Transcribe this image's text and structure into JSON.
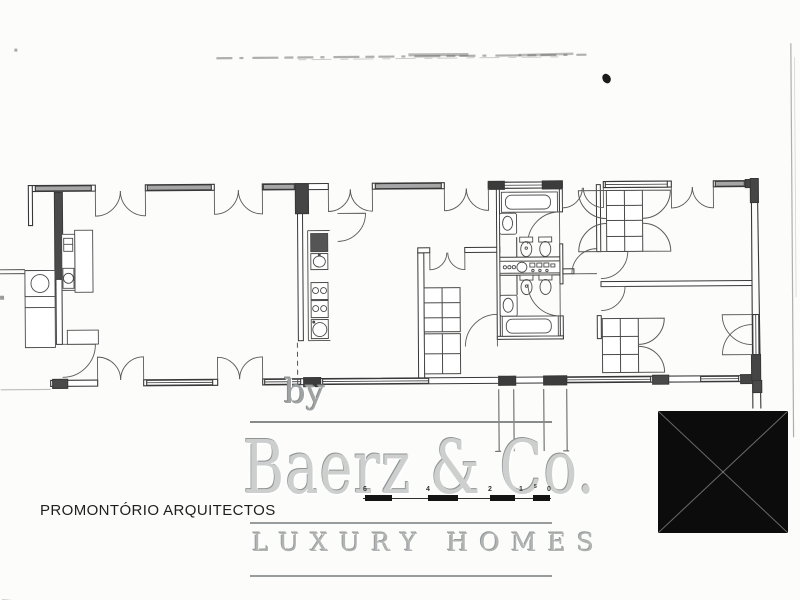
{
  "branding": {
    "by_label": "by",
    "company_name": "Baerz & Co.",
    "tagline": "LUXURY HOMES"
  },
  "architect": {
    "label": "PROMONTÓRIO ARQUITECTOS"
  },
  "scale_bar": {
    "tick_labels": [
      "6",
      "4",
      "2",
      "1",
      "5",
      "0"
    ]
  },
  "colors": {
    "plan_line": "#3a3a3a",
    "wall_fill": "#4a4a4a",
    "window_fill": "#a6a6a6",
    "watermark_gray": "#c9cbcb",
    "text_black": "#1f1f1f",
    "stamp_black": "#0c0c0c",
    "background": "#fcfcfb"
  }
}
